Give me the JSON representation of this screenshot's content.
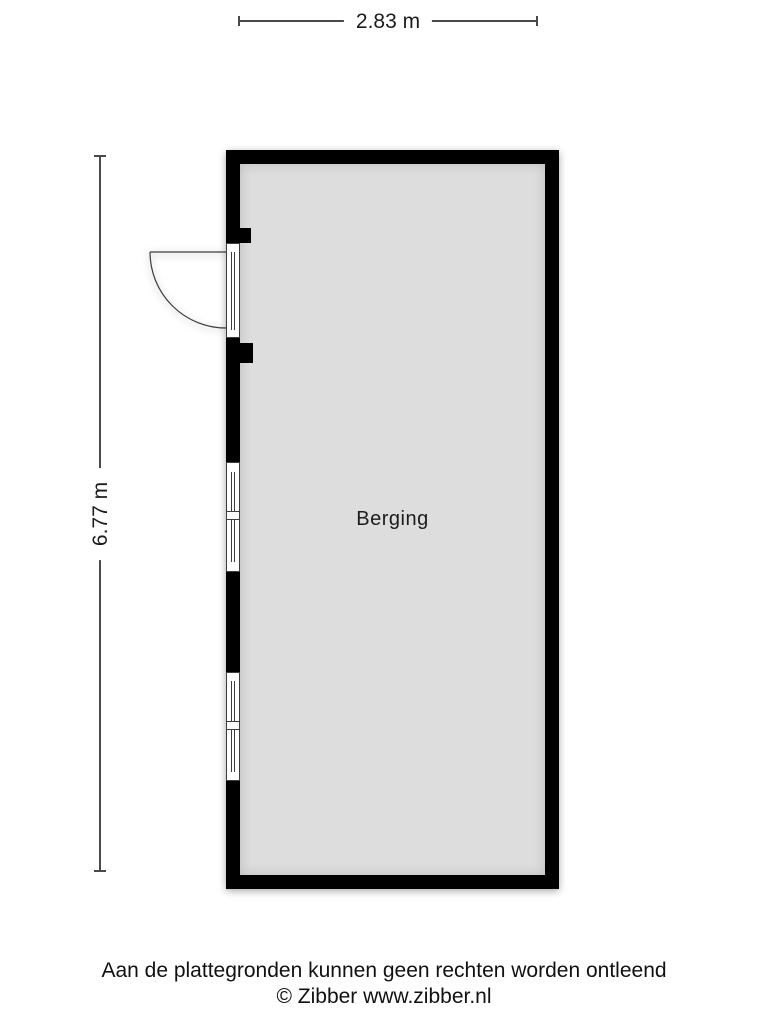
{
  "floorplan": {
    "room_label": "Berging",
    "width_label": "2.83 m",
    "height_label": "6.77 m"
  },
  "footer": {
    "disclaimer": "Aan de plattegronden kunnen geen rechten worden ontleend",
    "copyright": "© Zibber www.zibber.nl"
  },
  "colors": {
    "wall": "#000000",
    "floor_fill": "#dddddd",
    "frame_outline": "#3c3c3c",
    "dimension_line": "#4a4a4a",
    "text": "#1c1c1c",
    "background": "#ffffff"
  }
}
